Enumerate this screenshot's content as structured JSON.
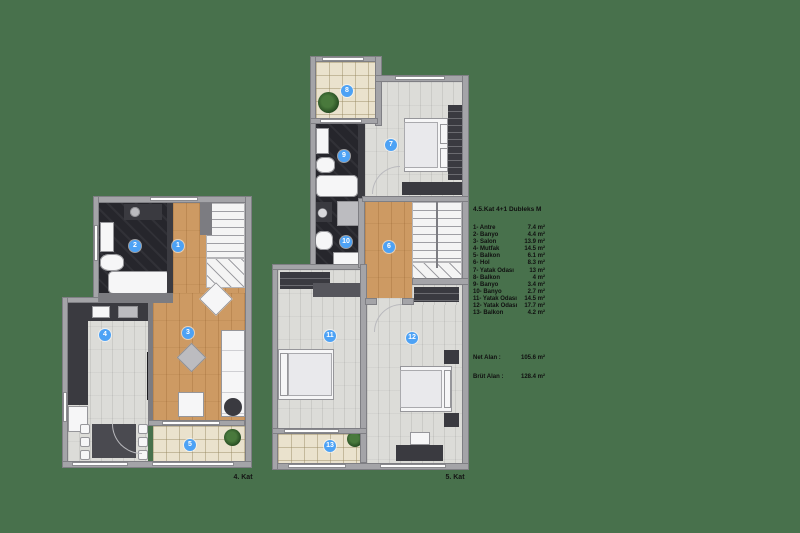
{
  "colors": {
    "background": "#48714c",
    "badge_blue": "#4da2f5",
    "wood_floor": "#cd9a63",
    "plank_floor": "#dcdcd8",
    "dark_tile": "#26262c",
    "balcony_tile": "#eae2cd",
    "wall_gray": "#a4a4a8",
    "wall_dark": "#3b3b41"
  },
  "legend": {
    "title": "4.5.Kat  4+1 Dubleks M",
    "items": [
      {
        "label": "1- Antre",
        "area": "7.4 m²"
      },
      {
        "label": "2- Banyo",
        "area": "4.4 m²"
      },
      {
        "label": "3- Salon",
        "area": "13.9 m²"
      },
      {
        "label": "4- Mutfak",
        "area": "14.5 m²"
      },
      {
        "label": "5- Balkon",
        "area": "6.1 m²"
      },
      {
        "label": "6- Hol",
        "area": "8.3 m²"
      },
      {
        "label": "7- Yatak Odası",
        "area": "13 m²"
      },
      {
        "label": "8- Balkon",
        "area": "4 m²"
      },
      {
        "label": "9- Banyo",
        "area": "3.4 m²"
      },
      {
        "label": "10- Banyo",
        "area": "2.7 m²"
      },
      {
        "label": "11- Yatak Odası",
        "area": "14.5 m²"
      },
      {
        "label": "12- Yatak Odası",
        "area": "17.7 m²"
      },
      {
        "label": "13- Balkon",
        "area": "4.2 m²"
      }
    ],
    "net_label": "Net Alan :",
    "net_value": "105.6 m²",
    "brut_label": "Brüt Alan :",
    "brut_value": "128.4 m²"
  },
  "plans": {
    "left": {
      "caption": "4. Kat",
      "badges": [
        "1",
        "2",
        "3",
        "4",
        "5"
      ]
    },
    "right": {
      "caption": "5. Kat",
      "badges": [
        "6",
        "7",
        "8",
        "9",
        "10",
        "11",
        "12",
        "13"
      ]
    }
  }
}
